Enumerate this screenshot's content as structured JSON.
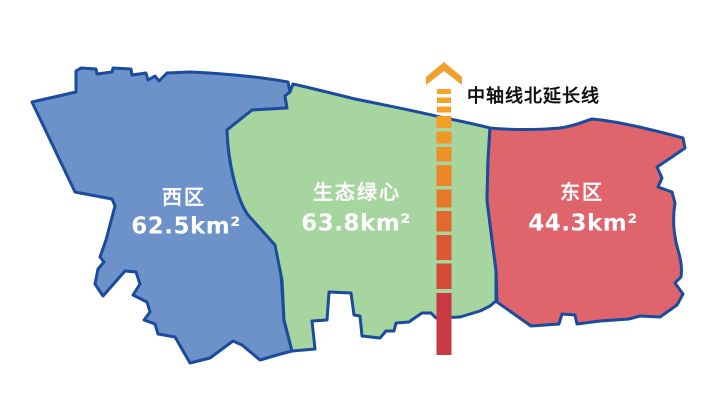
{
  "map": {
    "background": "#ffffff",
    "border_color": "#1A4B9C"
  },
  "regions": {
    "west": {
      "name": "西区",
      "area": "62.5km²",
      "fill": "#6D91C9"
    },
    "center": {
      "name": "生态绿心",
      "area": "63.8km²",
      "fill": "#A7D5A0"
    },
    "east": {
      "name": "东区",
      "area": "44.3km²",
      "fill": "#E0646C"
    }
  },
  "axis": {
    "label": "中轴线北延长线",
    "arrow_color": "#F0A02C",
    "segments": [
      "#F4A426",
      "#F4A426",
      "#F3A026",
      "#F29E27",
      "#F09827",
      "#EE9028",
      "#EC8629",
      "#E7782B",
      "#E2682E",
      "#DC5732",
      "#D54A36",
      "#CA3841"
    ]
  }
}
